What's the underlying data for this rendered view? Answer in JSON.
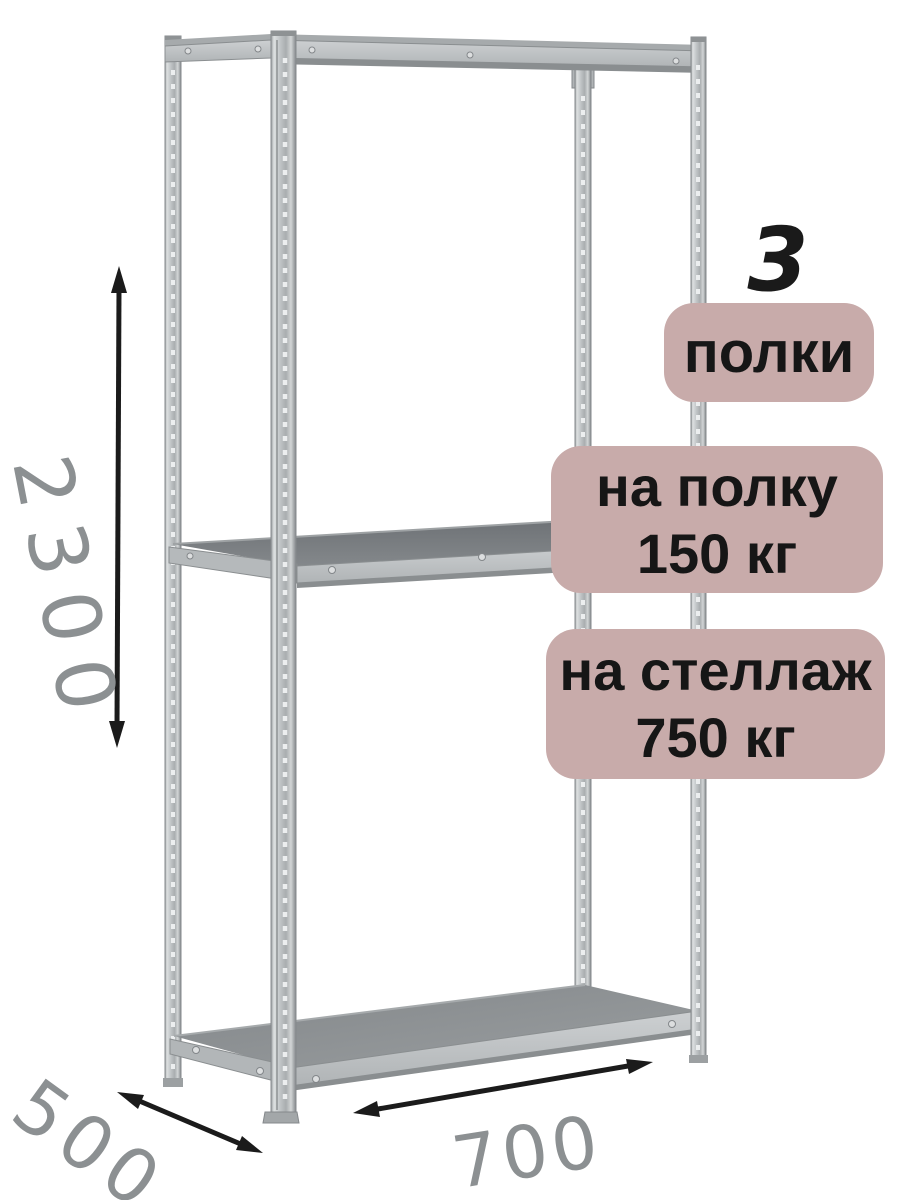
{
  "badges": {
    "count_number": "3",
    "count_label": "полки",
    "shelf_load_line1": "на полку",
    "shelf_load_line2": "150 кг",
    "rack_load_line1": "на стеллаж",
    "rack_load_line2": "750 кг"
  },
  "dimensions": {
    "height": "2300",
    "depth": "500",
    "width": "700"
  },
  "colors": {
    "background": "#ffffff",
    "badge_bg": "#c8abaa",
    "badge_text": "#161616",
    "count_text": "#1a1a1a",
    "dimension_text": "#8c9092",
    "arrow": "#1b1b1b",
    "metal_face": "#c3c7c9",
    "metal_edge": "#85898c",
    "shelf_top_middle": "#74787c",
    "shelf_top_bottom": "#8b8f91"
  }
}
